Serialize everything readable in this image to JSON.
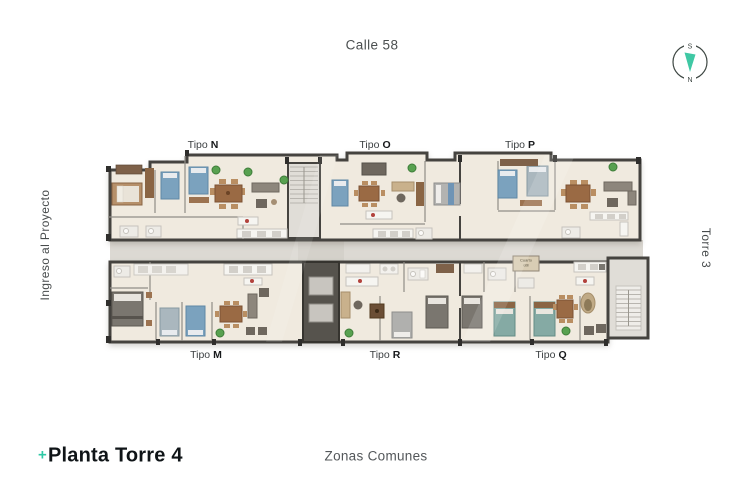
{
  "street": {
    "label": "Calle 58"
  },
  "compass": {
    "south": "S",
    "north": "N"
  },
  "left_side": {
    "label": "Ingreso al Proyecto"
  },
  "right_side": {
    "label": "Torre 3"
  },
  "plan": {
    "upper_units": [
      {
        "prefix": "Tipo",
        "letter": "N"
      },
      {
        "prefix": "Tipo",
        "letter": "O"
      },
      {
        "prefix": "Tipo",
        "letter": "P"
      }
    ],
    "lower_units": [
      {
        "prefix": "Tipo",
        "letter": "M"
      },
      {
        "prefix": "Tipo",
        "letter": "R"
      },
      {
        "prefix": "Tipo",
        "letter": "Q"
      }
    ],
    "utility_room": {
      "label": "Cuarto útil"
    }
  },
  "footer": {
    "plus": "+",
    "title": "Planta Torre 4",
    "center_label": "Zonas Comunes"
  },
  "colors": {
    "accent_teal": "#2ec9a6",
    "floor": "#f0eadf",
    "wall": "#45433f",
    "corridor": "#dcd9d3",
    "stair_gray": "#e0ddd7",
    "elevator_core": "#56534d",
    "bed_blue": "#7ba2be",
    "bed_teal": "#85aaa4",
    "wood": "#9a6a44",
    "plant_green": "#58a150",
    "text_dark": "#3d4143",
    "text_gray": "#53575a"
  }
}
